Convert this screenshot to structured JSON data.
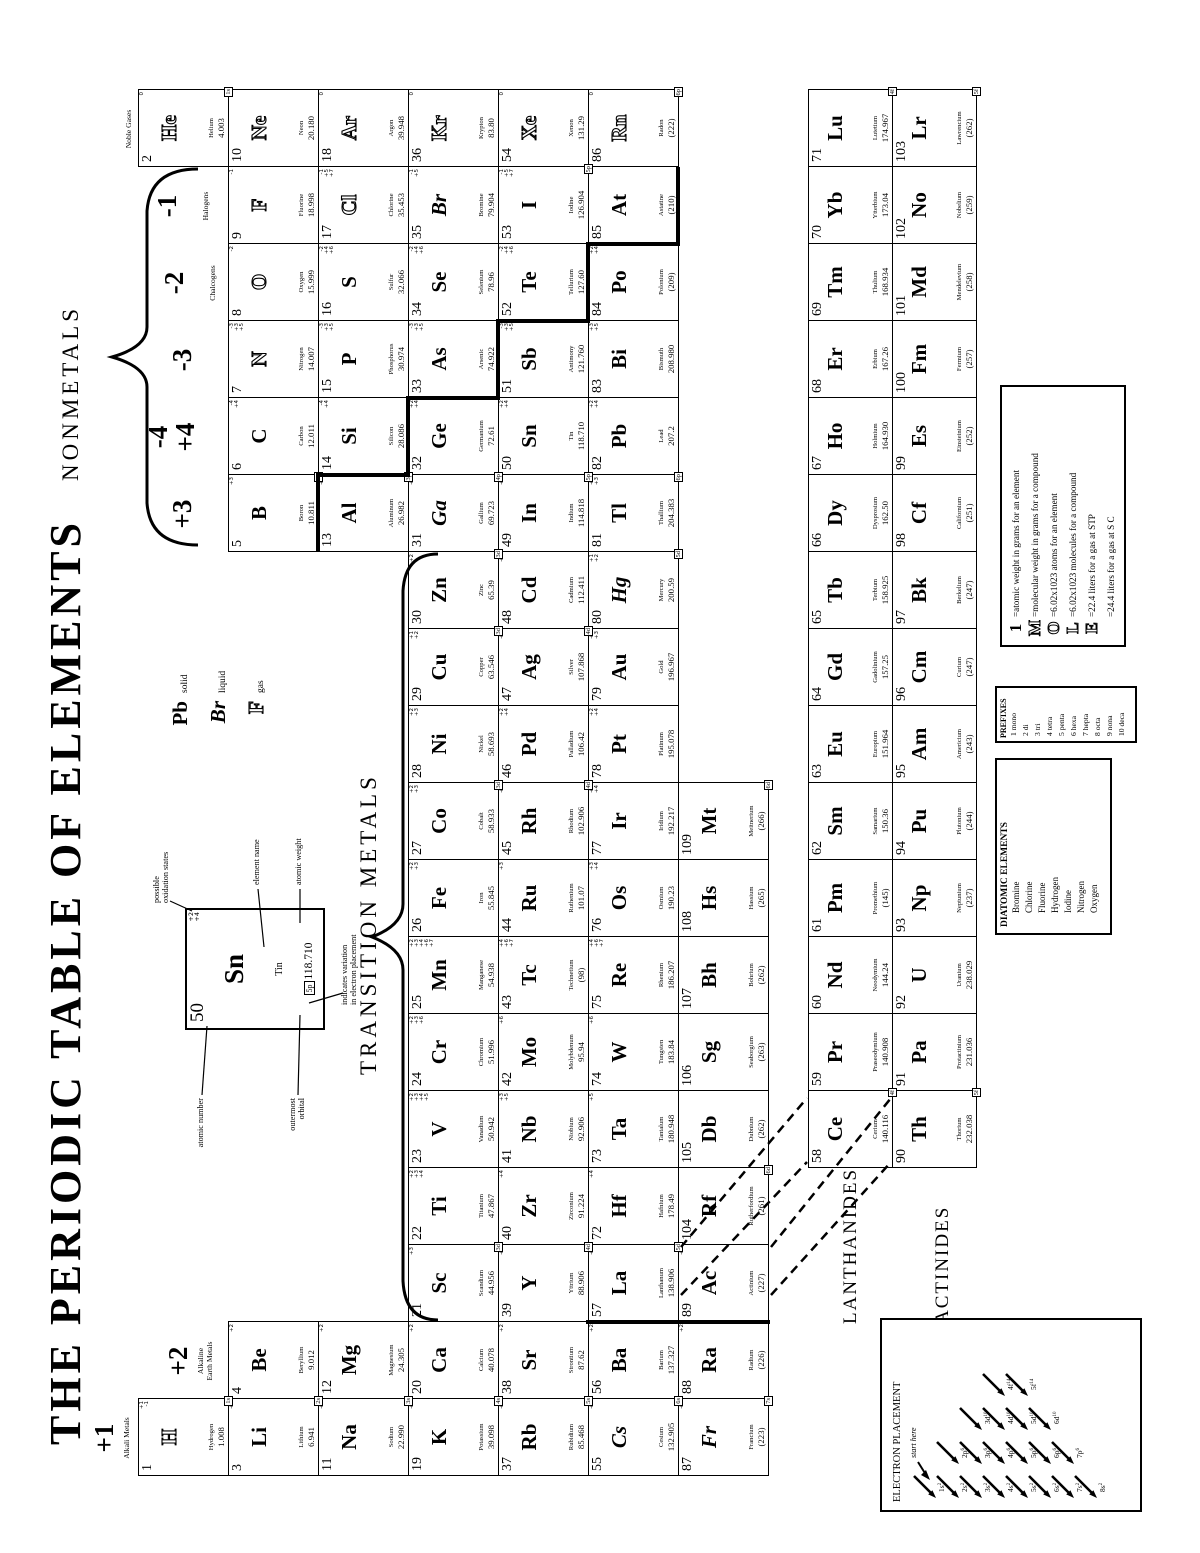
{
  "title": "THE PERIODIC TABLE OF ELEMENTS",
  "section_labels": {
    "nonmetals": "NONMETALS",
    "transition_metals": "TRANSITION METALS",
    "lanthanides": "LANTHANIDES",
    "actinides": "ACTINIDES"
  },
  "ox_labels": {
    "g1": "+1",
    "g2": "+2",
    "g13": "+3",
    "g14_top": "-4",
    "g14_bottom": "+4",
    "g15": "-3",
    "g16": "-2",
    "g17": "-1"
  },
  "family_labels": {
    "g1": "Alkali Metals",
    "g2": "Alkaline\nEarth Metals",
    "g16": "Chalcogens",
    "g17": "Halogens",
    "g18": "Noble Gases"
  },
  "state_legend": {
    "solid_symbol": "Pb",
    "solid_label": "solid",
    "liquid_symbol": "Br",
    "liquid_label": "liquid",
    "gas_symbol": "F",
    "gas_label": "gas"
  },
  "sample": {
    "number": "50",
    "symbol": "Sn",
    "name": "Tin",
    "weight": "118.710",
    "orbital": "5p",
    "oxidation": "+2 +4",
    "callouts": {
      "atomic_number": "atomic number",
      "oxidation_states": "possible\noxidation states",
      "element_name": "element name",
      "atomic_weight": "atomic weight",
      "outermost_orbital": "outermost\norbital",
      "variation": "indicates variation\nin electron placement"
    }
  },
  "mole": {
    "big": "1",
    "letters": [
      "1",
      "M",
      "O",
      "L",
      "E",
      ""
    ],
    "lines": [
      "=atomic weight in grams for an element",
      "=molecular weight in grams for a compound",
      "=6.02x1023 atoms for an element",
      "=6.02x1023 molecules for a compound",
      "=22.4 liters for a gas at STP",
      "=24.4 liters for a gas at S C"
    ]
  },
  "prefixes": {
    "title": "PREFIXES",
    "items": [
      "1 mono",
      "2 di",
      "3 tri",
      "4 tetra",
      "5 penta",
      "6 hexa",
      "7 hepta",
      "8 octa",
      "9 nona",
      "10 deca"
    ]
  },
  "diatomic": {
    "title": "DIATOMIC ELEMENTS",
    "items": [
      "Bromine",
      "Chlorine",
      "Fluorine",
      "Hydrogen",
      "Iodine",
      "Nitrogen",
      "Oxygen"
    ]
  },
  "electron_placement": {
    "title": "ELECTRON PLACEMENT",
    "start": "start here",
    "orbitals": [
      "1s",
      "2s",
      "2p",
      "3s",
      "3p",
      "3d",
      "4s",
      "4p",
      "4d",
      "4f",
      "5s",
      "5p",
      "5d",
      "5f",
      "6s",
      "6p",
      "6d",
      "7s",
      "7p",
      "8s"
    ],
    "superscripts": {
      "s": "2",
      "p": "6",
      "d": "10",
      "f": "14"
    }
  },
  "elements": [
    [
      1,
      "H",
      "Hydrogen",
      "1.008",
      1,
      1,
      "+1 -1",
      "1s",
      "g"
    ],
    [
      2,
      "He",
      "Helium",
      "4.003",
      1,
      18,
      "0",
      "1s",
      "g"
    ],
    [
      3,
      "Li",
      "Lithium",
      "6.941",
      2,
      1,
      "+1",
      "2s",
      "s"
    ],
    [
      4,
      "Be",
      "Beryllium",
      "9.012",
      2,
      2,
      "+2",
      "",
      "s"
    ],
    [
      5,
      "B",
      "Boron",
      "10.811",
      2,
      13,
      "+3",
      "2p",
      "s"
    ],
    [
      6,
      "C",
      "Carbon",
      "12.011",
      2,
      14,
      "-4 +4",
      "",
      "s"
    ],
    [
      7,
      "N",
      "Nitrogen",
      "14.007",
      2,
      15,
      "-3 +3 +5",
      "",
      "g"
    ],
    [
      8,
      "O",
      "Oxygen",
      "15.999",
      2,
      16,
      "-2",
      "",
      "g"
    ],
    [
      9,
      "F",
      "Fluorine",
      "18.998",
      2,
      17,
      "-1",
      "",
      "g"
    ],
    [
      10,
      "Ne",
      "Neon",
      "20.180",
      2,
      18,
      "0",
      "",
      "g"
    ],
    [
      11,
      "Na",
      "Sodium",
      "22.990",
      3,
      1,
      "+1",
      "3s",
      "s"
    ],
    [
      12,
      "Mg",
      "Magnesium",
      "24.305",
      3,
      2,
      "+2",
      "",
      "s"
    ],
    [
      13,
      "Al",
      "Aluminum",
      "26.982",
      3,
      13,
      "+3",
      "3p",
      "s"
    ],
    [
      14,
      "Si",
      "Silicon",
      "28.086",
      3,
      14,
      "-4 +4",
      "",
      "s"
    ],
    [
      15,
      "P",
      "Phosphorus",
      "30.974",
      3,
      15,
      "-3 +3 +5",
      "",
      "s"
    ],
    [
      16,
      "S",
      "Sulfur",
      "32.066",
      3,
      16,
      "-2 +4 +6",
      "",
      "s"
    ],
    [
      17,
      "Cl",
      "Chlorine",
      "35.453",
      3,
      17,
      "-1 +5 +7",
      "",
      "g"
    ],
    [
      18,
      "Ar",
      "Argon",
      "39.948",
      3,
      18,
      "0",
      "",
      "g"
    ],
    [
      19,
      "K",
      "Potassium",
      "39.098",
      4,
      1,
      "+1",
      "4s",
      "s"
    ],
    [
      20,
      "Ca",
      "Calcium",
      "40.078",
      4,
      2,
      "+2",
      "",
      "s"
    ],
    [
      21,
      "Sc",
      "Scandium",
      "44.956",
      4,
      3,
      "+3",
      "3d",
      "s"
    ],
    [
      22,
      "Ti",
      "Titanium",
      "47.867",
      4,
      4,
      "+2 +3 +4",
      "",
      "s"
    ],
    [
      23,
      "V",
      "Vanadium",
      "50.942",
      4,
      5,
      "+2 +3 +4 +5",
      "",
      "s"
    ],
    [
      24,
      "Cr",
      "Chromium",
      "51.996",
      4,
      6,
      "+2 +3 +6",
      "",
      "s"
    ],
    [
      25,
      "Mn",
      "Manganese",
      "54.938",
      4,
      7,
      "+2 +3 +4 +6 +7",
      "",
      "s"
    ],
    [
      26,
      "Fe",
      "Iron",
      "55.845",
      4,
      8,
      "+2 +3",
      "",
      "s"
    ],
    [
      27,
      "Co",
      "Cobalt",
      "58.933",
      4,
      9,
      "+2 +3",
      "3d",
      "s"
    ],
    [
      28,
      "Ni",
      "Nickel",
      "58.693",
      4,
      10,
      "+2 +3",
      "",
      "s"
    ],
    [
      29,
      "Cu",
      "Copper",
      "63.546",
      4,
      11,
      "+1 +2",
      "3d",
      "s"
    ],
    [
      30,
      "Zn",
      "Zinc",
      "65.39",
      4,
      12,
      "+2",
      "3d",
      "s"
    ],
    [
      31,
      "Ga",
      "Gallium",
      "69.723",
      4,
      13,
      "+3",
      "4p",
      "l"
    ],
    [
      32,
      "Ge",
      "Germanium",
      "72.61",
      4,
      14,
      "+2 +4",
      "",
      "s"
    ],
    [
      33,
      "As",
      "Arsenic",
      "74.922",
      4,
      15,
      "-3 +3 +5",
      "",
      "s"
    ],
    [
      34,
      "Se",
      "Selenium",
      "78.96",
      4,
      16,
      "-2 +4 +6",
      "",
      "s"
    ],
    [
      35,
      "Br",
      "Bromine",
      "79.904",
      4,
      17,
      "-1 +5",
      "",
      "l"
    ],
    [
      36,
      "Kr",
      "Krypton",
      "83.80",
      4,
      18,
      "0",
      "",
      "g"
    ],
    [
      37,
      "Rb",
      "Rubidium",
      "85.468",
      5,
      1,
      "+1",
      "5s",
      "s"
    ],
    [
      38,
      "Sr",
      "Strontium",
      "87.62",
      5,
      2,
      "+2",
      "",
      "s"
    ],
    [
      39,
      "Y",
      "Yttrium",
      "88.906",
      5,
      3,
      "+3",
      "4d",
      "s"
    ],
    [
      40,
      "Zr",
      "Zirconium",
      "91.224",
      5,
      4,
      "+4",
      "",
      "s"
    ],
    [
      41,
      "Nb",
      "Niobium",
      "92.906",
      5,
      5,
      "+3 +5",
      "",
      "s"
    ],
    [
      42,
      "Mo",
      "Molybdenum",
      "95.94",
      5,
      6,
      "+6",
      "",
      "s"
    ],
    [
      43,
      "Tc",
      "Technetium",
      "(98)",
      5,
      7,
      "+4 +6 +7",
      "",
      "s"
    ],
    [
      44,
      "Ru",
      "Ruthenium",
      "101.07",
      5,
      8,
      "+3",
      "",
      "s"
    ],
    [
      45,
      "Rh",
      "Rhodium",
      "102.906",
      5,
      9,
      "+3",
      "4d",
      "s"
    ],
    [
      46,
      "Pd",
      "Palladium",
      "106.42",
      5,
      10,
      "+2 +4",
      "",
      "s"
    ],
    [
      47,
      "Ag",
      "Silver",
      "107.868",
      5,
      11,
      "+1",
      "4d",
      "s"
    ],
    [
      48,
      "Cd",
      "Cadmium",
      "112.411",
      5,
      12,
      "+2",
      "",
      "s"
    ],
    [
      49,
      "In",
      "Indium",
      "114.818",
      5,
      13,
      "+3",
      "5p",
      "s"
    ],
    [
      50,
      "Sn",
      "Tin",
      "118.710",
      5,
      14,
      "+2 +4",
      "",
      "s"
    ],
    [
      51,
      "Sb",
      "Antimony",
      "121.760",
      5,
      15,
      "-3 +3 +5",
      "",
      "s"
    ],
    [
      52,
      "Te",
      "Tellurium",
      "127.60",
      5,
      16,
      "-2 +4 +6",
      "",
      "s"
    ],
    [
      53,
      "I",
      "Iodine",
      "126.904",
      5,
      17,
      "-1 +5 +7",
      "5p",
      "s"
    ],
    [
      54,
      "Xe",
      "Xenon",
      "131.29",
      5,
      18,
      "0",
      "",
      "g"
    ],
    [
      55,
      "Cs",
      "Cesium",
      "132.905",
      6,
      1,
      "+1",
      "6s",
      "l"
    ],
    [
      56,
      "Ba",
      "Barium",
      "137.327",
      6,
      2,
      "+2",
      "",
      "s"
    ],
    [
      57,
      "La",
      "Lanthanum",
      "138.906",
      6,
      3,
      "+3",
      "5d",
      "s"
    ],
    [
      72,
      "Hf",
      "Hafnium",
      "178.49",
      6,
      4,
      "+4",
      "",
      "s"
    ],
    [
      73,
      "Ta",
      "Tantalum",
      "180.948",
      6,
      5,
      "+5",
      "",
      "s"
    ],
    [
      74,
      "W",
      "Tungsten",
      "183.84",
      6,
      6,
      "+6",
      "",
      "s"
    ],
    [
      75,
      "Re",
      "Rhenium",
      "186.207",
      6,
      7,
      "+4 +6 +7",
      "",
      "s"
    ],
    [
      76,
      "Os",
      "Osmium",
      "190.23",
      6,
      8,
      "+3 +4",
      "",
      "s"
    ],
    [
      77,
      "Ir",
      "Iridium",
      "192.217",
      6,
      9,
      "+3 +4",
      "",
      "s"
    ],
    [
      78,
      "Pt",
      "Platinum",
      "195.078",
      6,
      10,
      "+2 +4",
      "",
      "s"
    ],
    [
      79,
      "Au",
      "Gold",
      "196.967",
      6,
      11,
      "+1 +3",
      "",
      "s"
    ],
    [
      80,
      "Hg",
      "Mercury",
      "200.59",
      6,
      12,
      "+1 +2",
      "5d",
      "l"
    ],
    [
      81,
      "Tl",
      "Thallium",
      "204.383",
      6,
      13,
      "+1 +3",
      "6p",
      "s"
    ],
    [
      82,
      "Pb",
      "Lead",
      "207.2",
      6,
      14,
      "+2 +4",
      "",
      "s"
    ],
    [
      83,
      "Bi",
      "Bismuth",
      "208.980",
      6,
      15,
      "+3 +5",
      "",
      "s"
    ],
    [
      84,
      "Po",
      "Polonium",
      "(209)",
      6,
      16,
      "+2 +4",
      "",
      "s"
    ],
    [
      85,
      "At",
      "Astatine",
      "(210)",
      6,
      17,
      "-1",
      "",
      "s"
    ],
    [
      86,
      "Rn",
      "Radon",
      "(222)",
      6,
      18,
      "0",
      "6p",
      "g"
    ],
    [
      87,
      "Fr",
      "Francium",
      "(223)",
      7,
      1,
      "+1",
      "7s",
      "l"
    ],
    [
      88,
      "Ra",
      "Radium",
      "(226)",
      7,
      2,
      "+2",
      "",
      "s"
    ],
    [
      89,
      "Ac",
      "Actinium",
      "(227)",
      7,
      3,
      "+3",
      "",
      "s"
    ],
    [
      104,
      "Rf",
      "Rutherfordium",
      "(261)",
      7,
      4,
      "",
      "6d",
      "s"
    ],
    [
      105,
      "Db",
      "Dubnium",
      "(262)",
      7,
      5,
      "",
      "",
      "s"
    ],
    [
      106,
      "Sg",
      "Seaborgium",
      "(263)",
      7,
      6,
      "",
      "",
      "s"
    ],
    [
      107,
      "Bh",
      "Bohrium",
      "(262)",
      7,
      7,
      "",
      "",
      "s"
    ],
    [
      108,
      "Hs",
      "Hassium",
      "(265)",
      7,
      8,
      "",
      "",
      "s"
    ],
    [
      109,
      "Mt",
      "Meitnerium",
      "(266)",
      7,
      9,
      "",
      "6d",
      "s"
    ],
    [
      58,
      "Ce",
      "Cerium",
      "140.116",
      8,
      5,
      "",
      "4f",
      "s"
    ],
    [
      59,
      "Pr",
      "Praseodymium",
      "140.908",
      8,
      6,
      "",
      "",
      "s"
    ],
    [
      60,
      "Nd",
      "Neodymium",
      "144.24",
      8,
      7,
      "",
      "",
      "s"
    ],
    [
      61,
      "Pm",
      "Promethium",
      "(145)",
      8,
      8,
      "",
      "",
      "s"
    ],
    [
      62,
      "Sm",
      "Samarium",
      "150.36",
      8,
      9,
      "",
      "",
      "s"
    ],
    [
      63,
      "Eu",
      "Europium",
      "151.964",
      8,
      10,
      "",
      "",
      "s"
    ],
    [
      64,
      "Gd",
      "Gadolinium",
      "157.25",
      8,
      11,
      "",
      "",
      "s"
    ],
    [
      65,
      "Tb",
      "Terbium",
      "158.925",
      8,
      12,
      "",
      "",
      "s"
    ],
    [
      66,
      "Dy",
      "Dysprosium",
      "162.50",
      8,
      13,
      "",
      "",
      "s"
    ],
    [
      67,
      "Ho",
      "Holmium",
      "164.930",
      8,
      14,
      "",
      "",
      "s"
    ],
    [
      68,
      "Er",
      "Erbium",
      "167.26",
      8,
      15,
      "",
      "",
      "s"
    ],
    [
      69,
      "Tm",
      "Thulium",
      "168.934",
      8,
      16,
      "",
      "",
      "s"
    ],
    [
      70,
      "Yb",
      "Ytterbium",
      "173.04",
      8,
      17,
      "",
      "",
      "s"
    ],
    [
      71,
      "Lu",
      "Lutetium",
      "174.967",
      8,
      18,
      "",
      "4f",
      "s"
    ],
    [
      90,
      "Th",
      "Thorium",
      "232.038",
      9,
      5,
      "",
      "5f",
      "s"
    ],
    [
      91,
      "Pa",
      "Protactinium",
      "231.036",
      9,
      6,
      "",
      "",
      "s"
    ],
    [
      92,
      "U",
      "Uranium",
      "238.029",
      9,
      7,
      "",
      "",
      "s"
    ],
    [
      93,
      "Np",
      "Neptunium",
      "(237)",
      9,
      8,
      "",
      "",
      "s"
    ],
    [
      94,
      "Pu",
      "Plutonium",
      "(244)",
      9,
      9,
      "",
      "",
      "s"
    ],
    [
      95,
      "Am",
      "Americium",
      "(243)",
      9,
      10,
      "",
      "",
      "s"
    ],
    [
      96,
      "Cm",
      "Curium",
      "(247)",
      9,
      11,
      "",
      "",
      "s"
    ],
    [
      97,
      "Bk",
      "Berkelium",
      "(247)",
      9,
      12,
      "",
      "",
      "s"
    ],
    [
      98,
      "Cf",
      "Californium",
      "(251)",
      9,
      13,
      "",
      "",
      "s"
    ],
    [
      99,
      "Es",
      "Einsteinium",
      "(252)",
      9,
      14,
      "",
      "",
      "s"
    ],
    [
      100,
      "Fm",
      "Fermium",
      "(257)",
      9,
      15,
      "",
      "",
      "s"
    ],
    [
      101,
      "Md",
      "Mendelevium",
      "(258)",
      9,
      16,
      "",
      "",
      "s"
    ],
    [
      102,
      "No",
      "Nobelium",
      "(259)",
      9,
      17,
      "",
      "",
      "s"
    ],
    [
      103,
      "Lr",
      "Lawrencium",
      "(262)",
      9,
      18,
      "",
      "5f",
      "s"
    ]
  ]
}
